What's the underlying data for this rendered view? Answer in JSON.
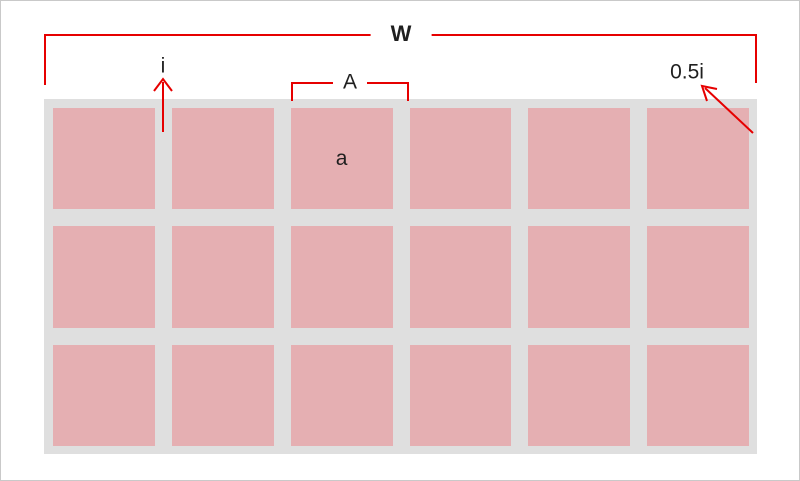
{
  "diagram": {
    "type": "dimension-diagram",
    "description": "Grid of 18 panels (6 columns x 3 rows) on a gray field with red dimension annotations",
    "labels": {
      "total_width": "W",
      "gap": "i",
      "pitch": "A",
      "edge_margin": "0.5i",
      "panel": "a"
    },
    "grid": {
      "rows": 3,
      "columns": 6,
      "panel_count": 18
    },
    "colors": {
      "panel_fill": "#e5afb2",
      "field_background": "#dfdfdf",
      "dimension_line": "#e60000",
      "label_text": "#1f1f1f",
      "canvas_border": "#c9c9c9",
      "canvas_background": "#ffffff"
    }
  }
}
